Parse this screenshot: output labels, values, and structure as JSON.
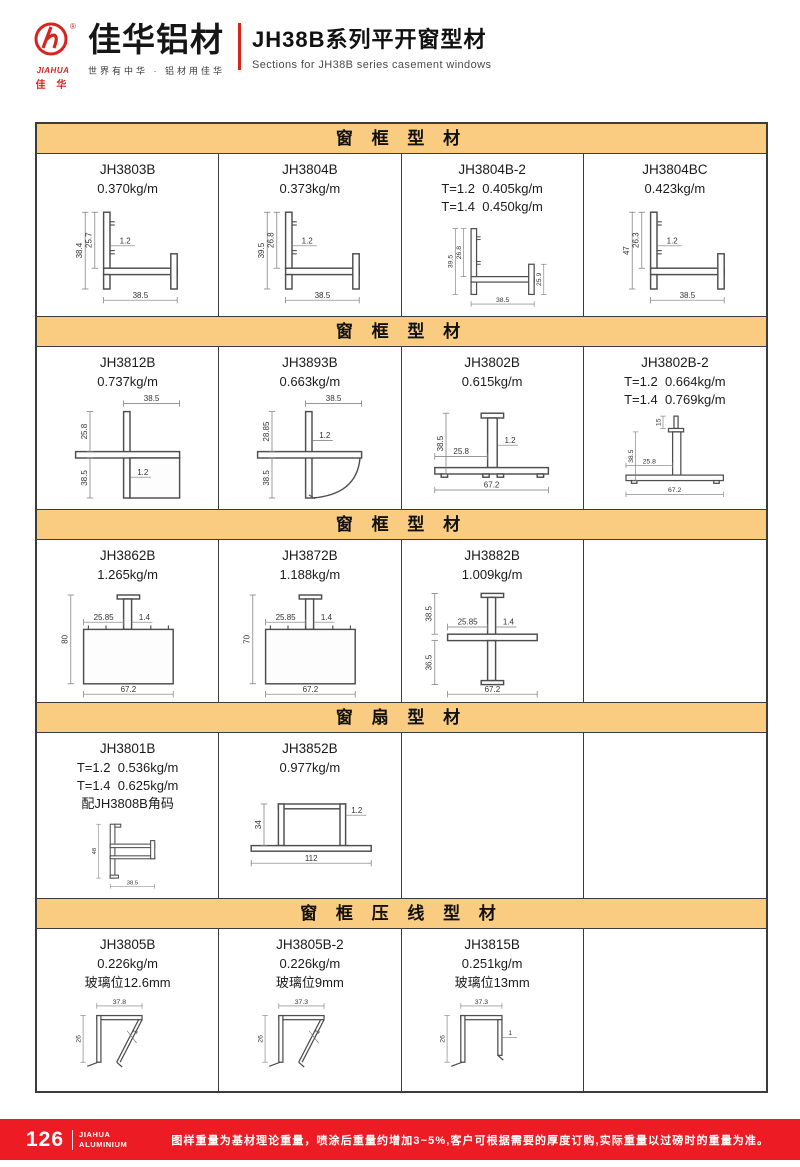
{
  "colors": {
    "accent_red": "#d6251f",
    "footer_red": "#ed1c24",
    "section_bg": "#f9cc82",
    "border": "#3c3c3c"
  },
  "header": {
    "logo_mark": "JIAHUA",
    "logo_mark_sub": "佳 华",
    "brand": "佳华铝材",
    "tagline": "世界有中华 · 铝材用佳华",
    "title_cn": "JH38B系列平开窗型材",
    "title_en": "Sections for JH38B series casement windows"
  },
  "sections": [
    {
      "title": "窗 框 型 材",
      "cells": [
        {
          "code": "JH3803B",
          "specs": [
            "0.370kg/m"
          ],
          "drawing": {
            "shape": "l-frame",
            "dims": {
              "left": "38.4",
              "inner": "25.7",
              "wall": "1.2",
              "bottom": "38.5"
            }
          }
        },
        {
          "code": "JH3804B",
          "specs": [
            "0.373kg/m"
          ],
          "drawing": {
            "shape": "l-frame",
            "dims": {
              "left": "39.5",
              "inner": "26.8",
              "wall": "1.2",
              "bottom": "38.5"
            }
          }
        },
        {
          "code": "JH3804B-2",
          "specs": [
            "T=1.2  0.405kg/m",
            "T=1.4  0.450kg/m"
          ],
          "drawing": {
            "shape": "l-frame",
            "dims": {
              "left": "39.5",
              "inner": "26.8",
              "right": "25.9",
              "bottom": "38.5"
            }
          }
        },
        {
          "code": "JH3804BC",
          "specs": [
            "0.423kg/m"
          ],
          "drawing": {
            "shape": "l-frame",
            "dims": {
              "left": "47",
              "inner": "26.3",
              "wall": "1.2",
              "bottom": "38.5"
            }
          }
        }
      ]
    },
    {
      "title": "窗 框 型 材",
      "cells": [
        {
          "code": "JH3812B",
          "specs": [
            "0.737kg/m"
          ],
          "drawing": {
            "shape": "corner-square",
            "dims": {
              "top": "38.5",
              "upper": "25.8",
              "lower": "38.5",
              "wall": "1.2"
            }
          }
        },
        {
          "code": "JH3893B",
          "specs": [
            "0.663kg/m"
          ],
          "drawing": {
            "shape": "corner-round",
            "dims": {
              "top": "38.5",
              "upper": "28.85",
              "lower": "38.5",
              "wall": "1.2"
            }
          }
        },
        {
          "code": "JH3802B",
          "specs": [
            "0.615kg/m"
          ],
          "drawing": {
            "shape": "t-mullion",
            "dims": {
              "left": "38.5",
              "inner": "25.8",
              "wall": "1.2",
              "bottom": "67.2"
            }
          }
        },
        {
          "code": "JH3802B-2",
          "specs": [
            "T=1.2  0.664kg/m",
            "T=1.4  0.769kg/m"
          ],
          "drawing": {
            "shape": "t-mullion-2",
            "dims": {
              "stem": "15",
              "left": "38.5",
              "inner": "25.8",
              "bottom": "67.2"
            }
          }
        }
      ]
    },
    {
      "title": "窗 框 型 材",
      "cells": [
        {
          "code": "JH3862B",
          "specs": [
            "1.265kg/m"
          ],
          "drawing": {
            "shape": "t-box",
            "dims": {
              "left": "80",
              "inner": "25.85",
              "wall": "1.4",
              "bottom": "67.2"
            }
          }
        },
        {
          "code": "JH3872B",
          "specs": [
            "1.188kg/m"
          ],
          "drawing": {
            "shape": "t-box",
            "dims": {
              "left": "70",
              "inner": "25.85",
              "wall": "1.4",
              "bottom": "67.2"
            }
          }
        },
        {
          "code": "JH3882B",
          "specs": [
            "1.009kg/m"
          ],
          "drawing": {
            "shape": "cross",
            "dims": {
              "upper": "38.5",
              "inner": "25.85",
              "wall": "1.4",
              "lower": "36.5",
              "bottom": "67.2"
            }
          }
        },
        null
      ]
    },
    {
      "title": "窗 扇 型 材",
      "cells": [
        {
          "code": "JH3801B",
          "specs": [
            "T=1.2  0.536kg/m",
            "T=1.4  0.625kg/m",
            "配JH3808B角码"
          ],
          "drawing": {
            "shape": "sash-z",
            "dims": {
              "left": "48",
              "bottom": "38.5"
            }
          }
        },
        {
          "code": "JH3852B",
          "specs": [
            "0.977kg/m"
          ],
          "drawing": {
            "shape": "wide-sash",
            "dims": {
              "left": "34",
              "wall": "1.2",
              "bottom": "112"
            }
          }
        },
        null,
        null
      ]
    },
    {
      "title": "窗 框 压 线 型 材",
      "cells": [
        {
          "code": "JH3805B",
          "specs": [
            "0.226kg/m",
            "玻璃位12.6mm"
          ],
          "drawing": {
            "shape": "bead",
            "dims": {
              "top": "37.8",
              "left": "26",
              "wall": "1"
            }
          }
        },
        {
          "code": "JH3805B-2",
          "specs": [
            "0.226kg/m",
            "玻璃位9mm"
          ],
          "drawing": {
            "shape": "bead",
            "dims": {
              "top": "37.3",
              "left": "26",
              "wall": "1"
            }
          }
        },
        {
          "code": "JH3815B",
          "specs": [
            "0.251kg/m",
            "玻璃位13mm"
          ],
          "drawing": {
            "shape": "bead-l",
            "dims": {
              "top": "37.3",
              "left": "26",
              "wall": "1"
            }
          }
        },
        null
      ]
    }
  ],
  "footer": {
    "page": "126",
    "brand_line1": "JIAHUA",
    "brand_line2": "ALUMINIUM",
    "note": "图样重量为基材理论重量，喷涂后重量约增加3~5%,客户可根据需要的厚度订购,实际重量以过磅时的重量为准。"
  }
}
